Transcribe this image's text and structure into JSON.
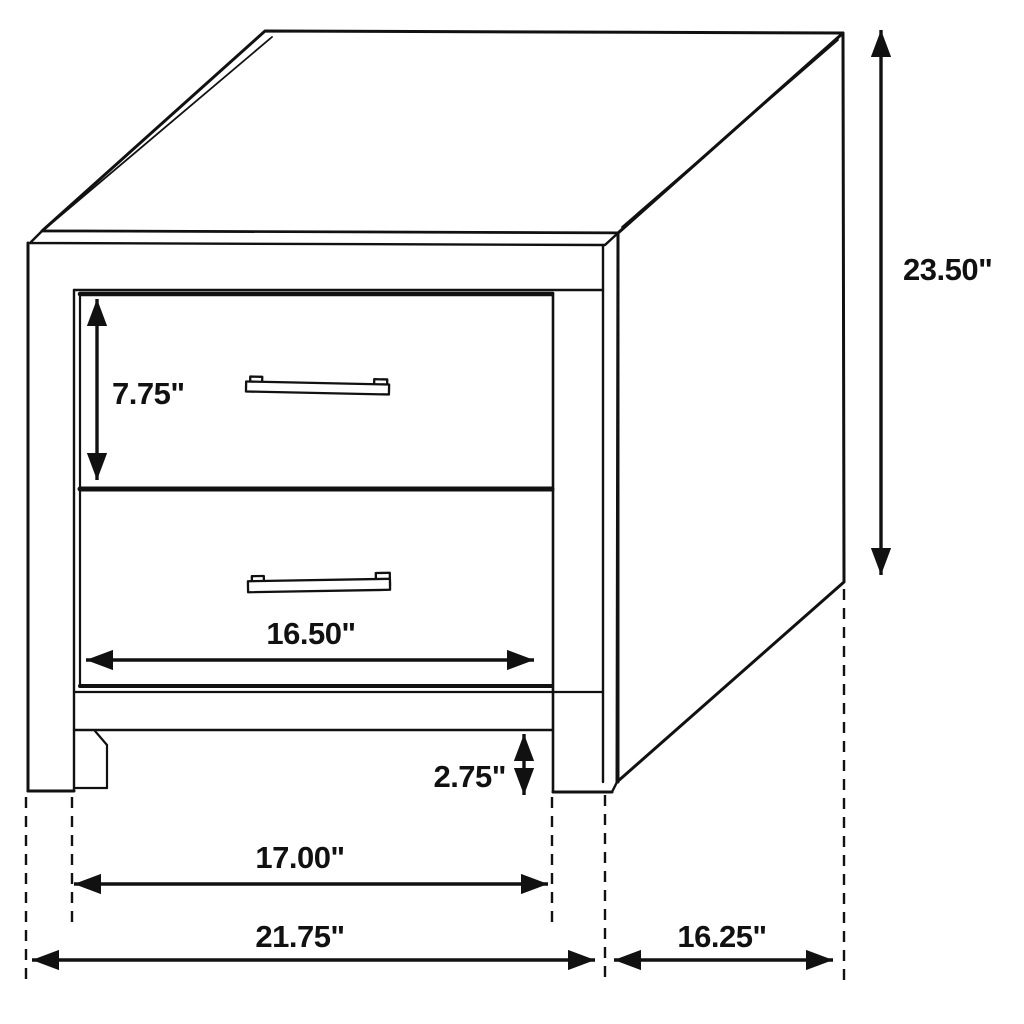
{
  "figure": {
    "type": "furniture-dimension-diagram",
    "subject": "two-drawer nightstand line drawing",
    "unit": "inches",
    "colors": {
      "line": "#111111",
      "background": "#ffffff"
    },
    "dimensions": {
      "overall_height": {
        "label": "23.50\"",
        "inches": 23.5
      },
      "top_drawer_height": {
        "label": "7.75\"",
        "inches": 7.75
      },
      "drawer_width": {
        "label": "16.50\"",
        "inches": 16.5
      },
      "leg_height": {
        "label": "2.75\"",
        "inches": 2.75
      },
      "leg_span_width": {
        "label": "17.00\"",
        "inches": 17.0
      },
      "overall_width": {
        "label": "21.75\"",
        "inches": 21.75
      },
      "depth": {
        "label": "16.25\"",
        "inches": 16.25
      }
    }
  }
}
